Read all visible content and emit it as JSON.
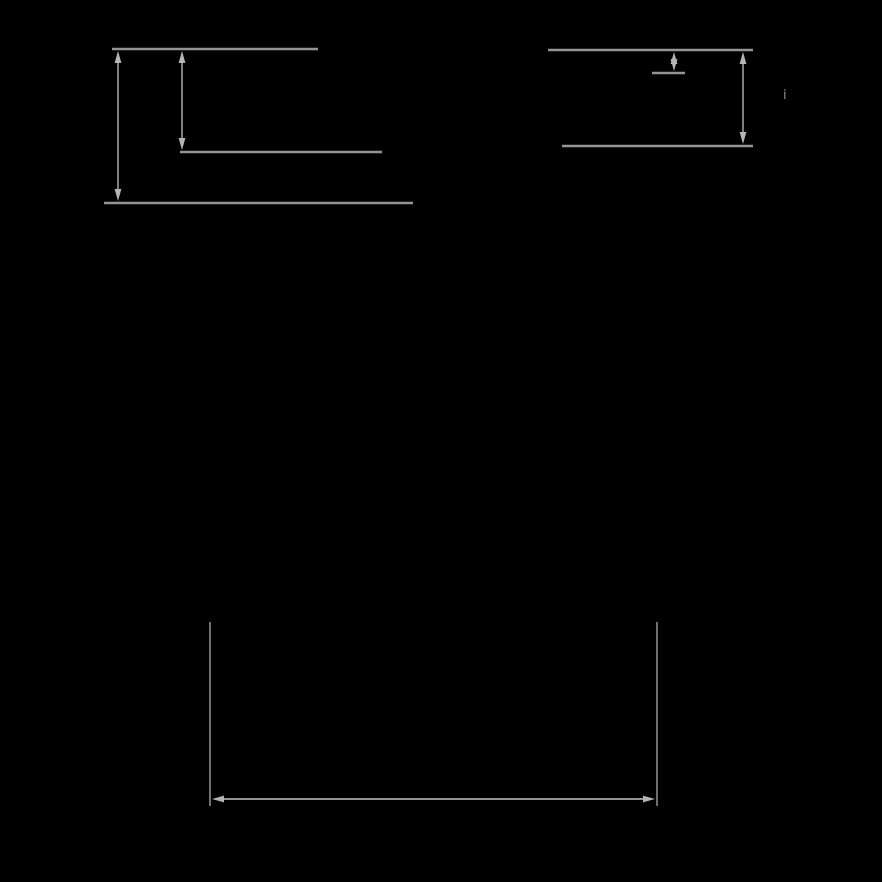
{
  "diagram": {
    "background": "#000000",
    "line_color": "#949494",
    "arrow_color": "#b5b5b5",
    "label": {
      "text": "i",
      "color": "#8f8f8f"
    },
    "groups": {
      "left_levels": {
        "levels": [
          {
            "id": "left-level-top",
            "x1": 112,
            "x2": 318,
            "y": 49
          },
          {
            "id": "left-level-middle",
            "x1": 180,
            "x2": 382,
            "y": 152
          },
          {
            "id": "left-level-bottom",
            "x1": 104,
            "x2": 413,
            "y": 203
          }
        ],
        "v_arrows": [
          {
            "id": "left-span-full-arrow",
            "x": 118,
            "y1": 51,
            "y2": 201
          },
          {
            "id": "left-span-upper-arrow",
            "x": 182,
            "y1": 51,
            "y2": 150
          }
        ]
      },
      "right_levels": {
        "levels": [
          {
            "id": "right-level-top",
            "x1": 548,
            "x2": 753,
            "y": 50
          },
          {
            "id": "right-level-short",
            "x1": 652,
            "x2": 685,
            "y": 73
          },
          {
            "id": "right-level-bottom",
            "x1": 562,
            "x2": 753,
            "y": 146
          }
        ],
        "v_arrows": [
          {
            "id": "right-span-small-arrow",
            "x": 674,
            "y1": 52,
            "y2": 71
          },
          {
            "id": "right-span-full-arrow",
            "x": 743,
            "y1": 52,
            "y2": 144
          }
        ]
      },
      "bottom_width": {
        "extension_lines": [
          {
            "id": "bottom-left-extension-line",
            "x": 210,
            "y1": 622,
            "y2": 806
          },
          {
            "id": "bottom-right-extension-line",
            "x": 657,
            "y1": 622,
            "y2": 806
          }
        ],
        "h_arrows": [
          {
            "id": "bottom-width-arrow",
            "y": 799,
            "x1": 212,
            "x2": 655
          }
        ]
      }
    },
    "style": {
      "level_stroke_width": 2.6,
      "extension_stroke_width": 1.5,
      "arrow_shaft_width": 1.7,
      "arrow_head_length": 12,
      "arrow_head_half_width": 3.4
    }
  }
}
